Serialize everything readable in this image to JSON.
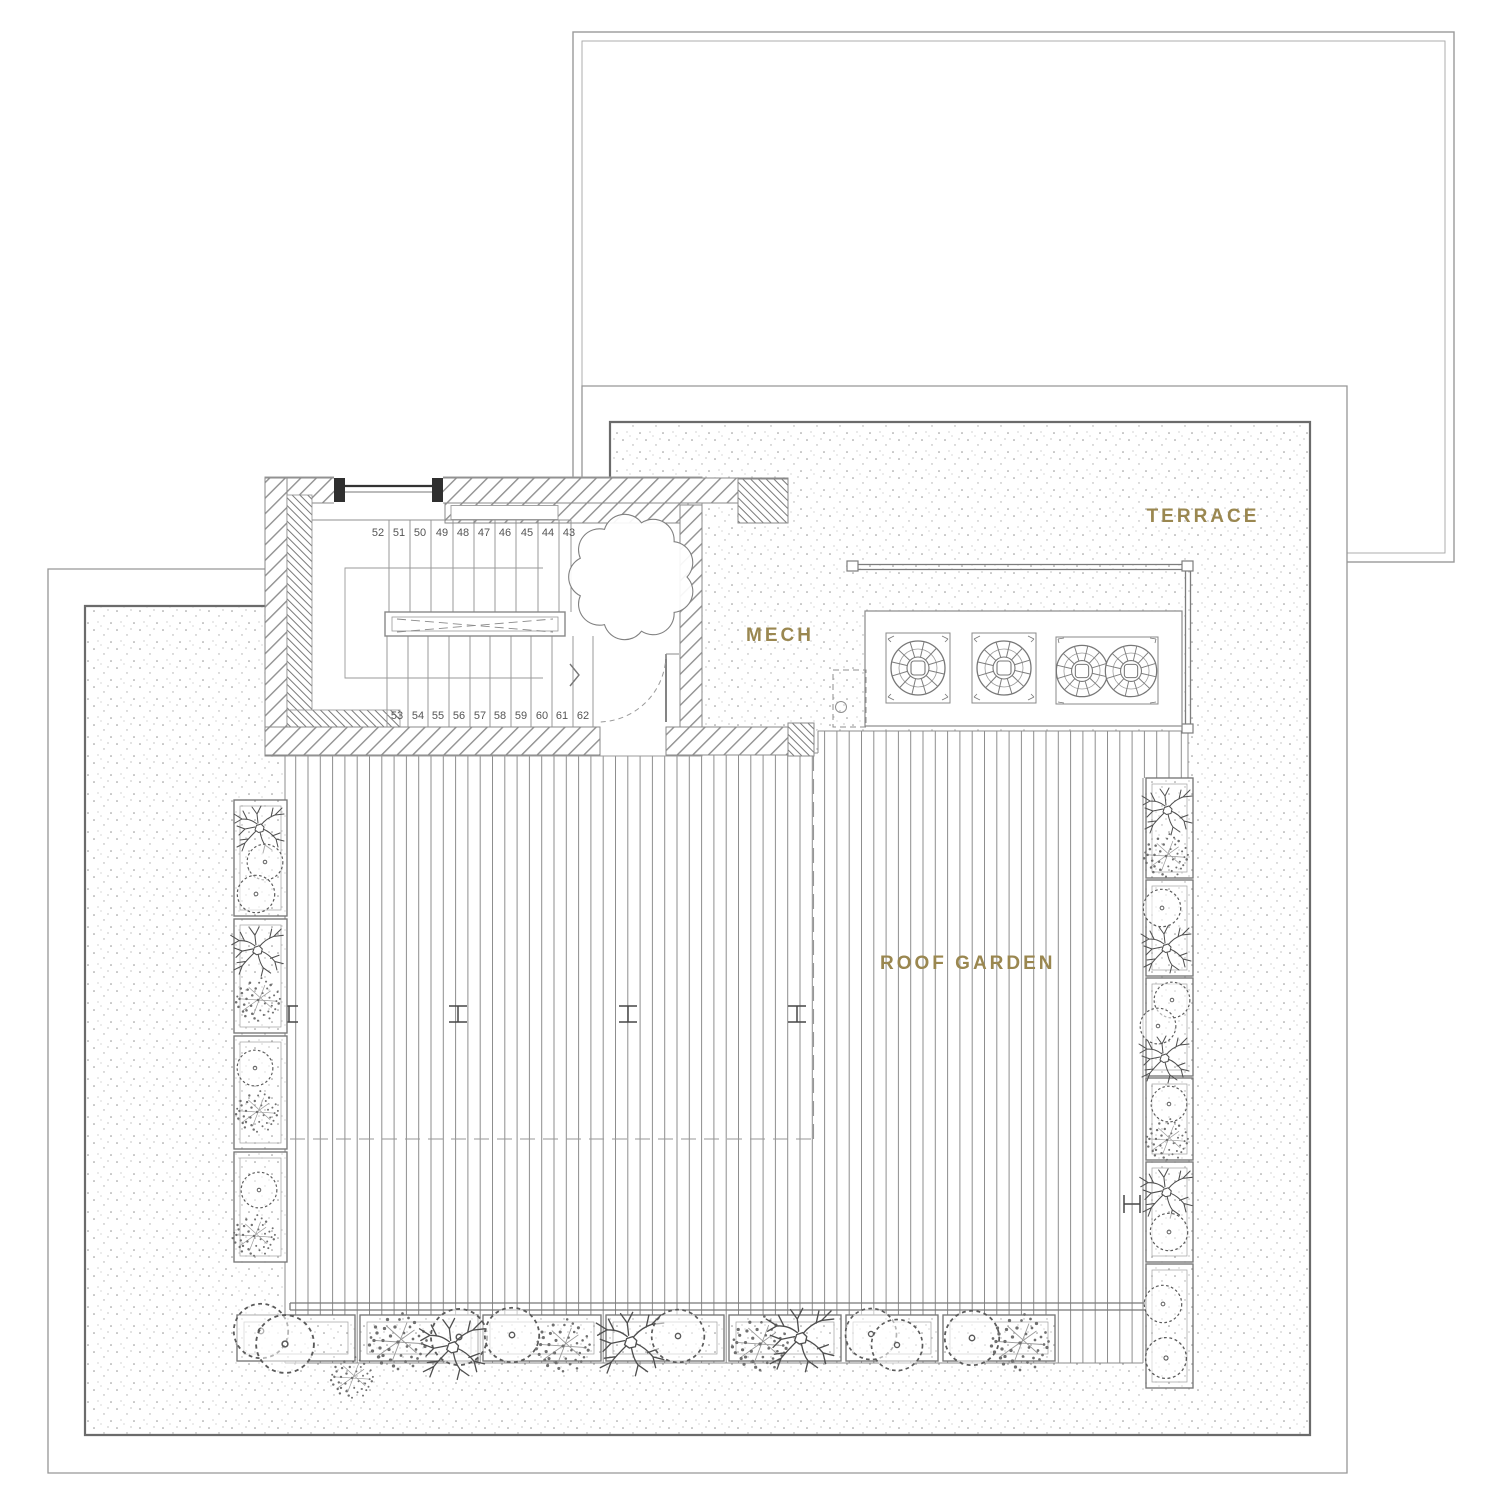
{
  "labels": {
    "terrace": "TERRACE",
    "mech": "MECH",
    "roof_garden": "ROOF GARDEN"
  },
  "stairs": {
    "top_numbers": [
      "52",
      "51",
      "50",
      "49",
      "48",
      "47",
      "46",
      "45",
      "44",
      "43"
    ],
    "bottom_numbers": [
      "53",
      "54",
      "55",
      "56",
      "57",
      "58",
      "59",
      "60",
      "61",
      "62"
    ]
  },
  "colors": {
    "accent_gold": "#9a8750",
    "line_gray": "#8a8a8a",
    "stipple_border": "#6b6b6b",
    "stair_number_gray": "#555555"
  }
}
